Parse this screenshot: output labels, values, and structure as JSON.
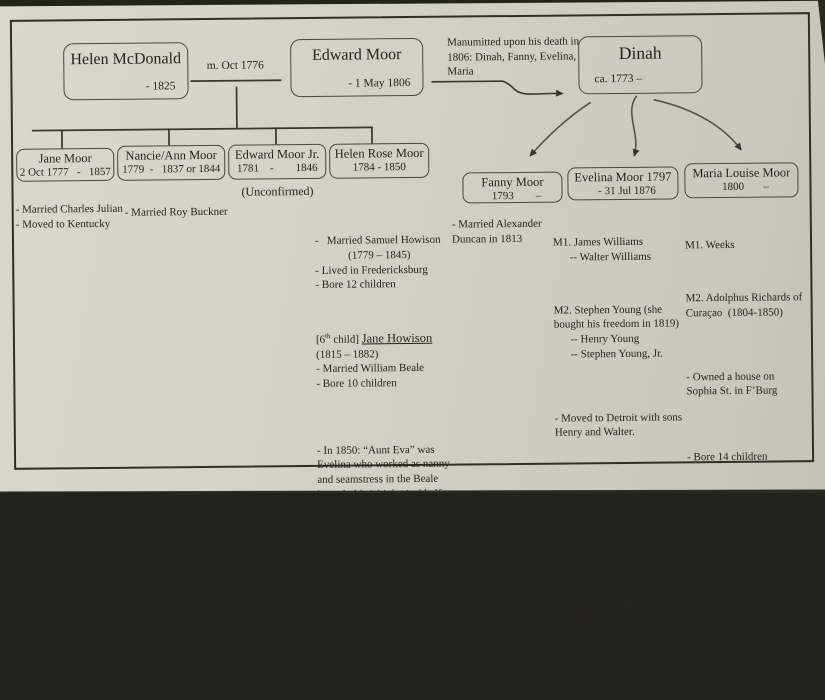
{
  "couple": {
    "wife": {
      "name": "Helen McDonald",
      "death": "- 1825"
    },
    "marriage_label": "m. Oct 1776",
    "husband": {
      "name": "Edward Moor",
      "death": "- 1 May 1806"
    }
  },
  "dinah": {
    "name": "Dinah",
    "birth": "ca. 1773 –"
  },
  "manumission_note": "Manumitted upon his death in\n1806: Dinah, Fanny, Evelina,\nMaria",
  "children_left": [
    {
      "name": "Jane Moor",
      "dates": "2 Oct 1777   -   1857"
    },
    {
      "name": "Nancie/Ann Moor",
      "dates": "1779  -   1837 or 1844"
    },
    {
      "name": "Edward Moor Jr.",
      "dates": "1781    -        1846",
      "tag": "(Unconfirmed)"
    },
    {
      "name": "Helen Rose Moor",
      "dates": "1784 - 1850"
    }
  ],
  "children_right": [
    {
      "name": "Fanny Moor",
      "dates": "1793        –"
    },
    {
      "name": "Evelina Moor 1797",
      "dates": "- 31 Jul 1876"
    },
    {
      "name": "Maria Louise Moor",
      "dates": "1800       –"
    }
  ],
  "notes": {
    "jane": "- Married Charles Julian\n- Moved to Kentucky",
    "nancie": "- Married Roy Buckner",
    "helen_rose": {
      "p1": "-   Married Samuel Howison\n            (1779 – 1845)\n- Lived in Fredericksburg\n- Bore 12 children",
      "p2_pre": "[6",
      "p2_sup": "th",
      "p2_mid": " child] ",
      "p2_name": "Jane Howison",
      "p2_rest": "          (1815 – 1882)\n- Married William Beale\n- Bore 10 children",
      "p3": "- In 1850: “Aunt Eva” was\nEvelina who worked as nanny\nand seamstress in the Beale\nhousehold. A biological half-\naunt.",
      "p4_name": "Marion Gamble ",
      "p4_rest": "descends\nfrom Jane Howison and\nWilliam Beale"
    },
    "fanny": "- Married Alexander\nDuncan in 1813",
    "evelina": {
      "m1": "M1. James Williams\n      -- Walter Williams",
      "m2": "M2. Stephen Young (she\nbought his freedom in 1819)\n      -- Henry Young\n      -- Stephen Young, Jr.",
      "moved": "- Moved to Detroit with sons\nHenry and Walter.",
      "desc1_name": "Kimberly Crafton",
      "desc1_rest": "descends from Evelina and\nWalter Williams",
      "desc2_name": "Stephannie Addison",
      "desc2_rest": "descends from Evelina and\nStephen Young, Jr."
    },
    "maria": {
      "m1": "M1. Weeks",
      "m2": "M2. Adolphus Richards of\nCuraçao  (1804-1850)",
      "house": "- Owned a house on\nSophia St. in F’Burg",
      "bore": "- Bore 14 children",
      "moved": "-   Moved to Toronto, then\n     Detroit.",
      "family": "-   Family was active in the\n     final stop of\n     Underground Railroad\n     to Toronto"
    }
  },
  "colors": {
    "paper": "#d5d1c9",
    "ink": "#29221b",
    "line": "#3b352c",
    "photo_bg": "#22231d"
  }
}
